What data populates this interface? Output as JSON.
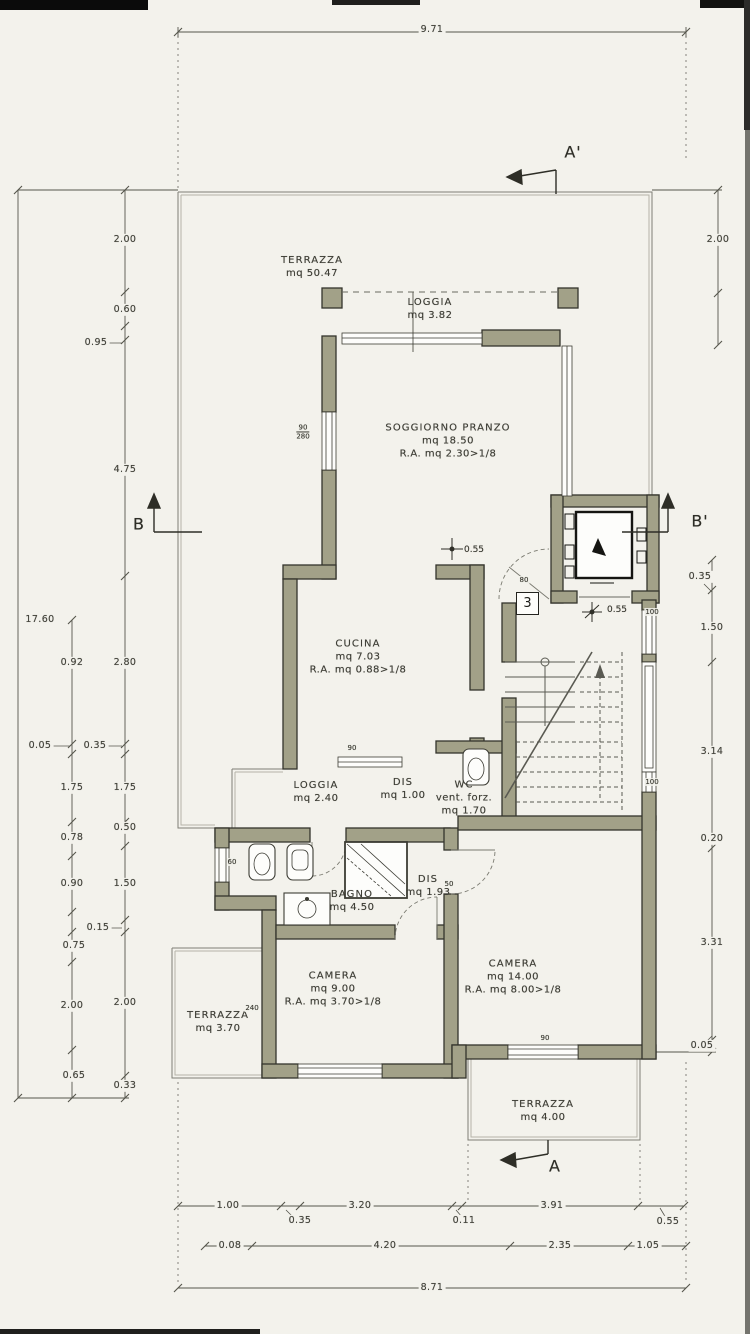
{
  "colors": {
    "paper": "#f3f2ec",
    "wall_fill": "#a2a188",
    "wall_stroke": "#34342c",
    "dim_line": "#55554c"
  },
  "unit_number": "3",
  "section_markers": {
    "a_top": "A'",
    "a_bottom": "A",
    "b_left": "B",
    "b_right": "B'"
  },
  "rooms": [
    {
      "id": "terrazza-grande",
      "cx": 312,
      "cy": 267,
      "lines": [
        "TERRAZZA",
        "mq 50.47"
      ]
    },
    {
      "id": "loggia-nord",
      "cx": 430,
      "cy": 309,
      "lines": [
        "LOGGIA",
        "mq 3.82"
      ]
    },
    {
      "id": "soggiorno-pranzo",
      "cx": 448,
      "cy": 441,
      "lines": [
        "SOGGIORNO PRANZO",
        "mq 18.50",
        "R.A. mq 2.30>1/8"
      ]
    },
    {
      "id": "cucina",
      "cx": 358,
      "cy": 657,
      "lines": [
        "CUCINA",
        "mq 7.03",
        "R.A. mq 0.88>1/8"
      ]
    },
    {
      "id": "loggia-ovest",
      "cx": 316,
      "cy": 792,
      "lines": [
        "LOGGIA",
        "mq 2.40"
      ]
    },
    {
      "id": "disimpegno-1",
      "cx": 403,
      "cy": 789,
      "lines": [
        "DIS",
        "mq 1.00"
      ]
    },
    {
      "id": "wc",
      "cx": 464,
      "cy": 798,
      "lines": [
        "WC",
        "vent. forz.",
        "mq 1.70"
      ]
    },
    {
      "id": "bagno",
      "cx": 352,
      "cy": 901,
      "lines": [
        "BAGNO",
        "mq 4.50"
      ]
    },
    {
      "id": "disimpegno-2",
      "cx": 428,
      "cy": 886,
      "lines": [
        "DIS",
        "mq 1.93"
      ]
    },
    {
      "id": "camera-1",
      "cx": 333,
      "cy": 989,
      "lines": [
        "CAMERA",
        "mq 9.00",
        "R.A. mq 3.70>1/8"
      ]
    },
    {
      "id": "camera-2",
      "cx": 513,
      "cy": 977,
      "lines": [
        "CAMERA",
        "mq 14.00",
        "R.A. mq 8.00>1/8"
      ]
    },
    {
      "id": "terrazza-ovest",
      "cx": 218,
      "cy": 1022,
      "lines": [
        "TERRAZZA",
        "mq 3.70"
      ]
    },
    {
      "id": "terrazza-sud",
      "cx": 543,
      "cy": 1111,
      "lines": [
        "TERRAZZA",
        "mq 4.00"
      ]
    }
  ],
  "dimensions": [
    {
      "x": 432,
      "y": 30,
      "t": "9.71"
    },
    {
      "x": 40,
      "y": 620,
      "t": "17.60"
    },
    {
      "x": 125,
      "y": 240,
      "t": "2.00"
    },
    {
      "x": 125,
      "y": 310,
      "t": "0.60"
    },
    {
      "x": 96,
      "y": 343,
      "t": "0.95"
    },
    {
      "x": 125,
      "y": 470,
      "t": "4.75"
    },
    {
      "x": 125,
      "y": 663,
      "t": "2.80"
    },
    {
      "x": 95,
      "y": 746,
      "t": "0.35"
    },
    {
      "x": 125,
      "y": 788,
      "t": "1.75"
    },
    {
      "x": 125,
      "y": 828,
      "t": "0.50"
    },
    {
      "x": 125,
      "y": 884,
      "t": "1.50"
    },
    {
      "x": 98,
      "y": 928,
      "t": "0.15"
    },
    {
      "x": 125,
      "y": 1003,
      "t": "2.00"
    },
    {
      "x": 125,
      "y": 1086,
      "t": "0.33"
    },
    {
      "x": 72,
      "y": 663,
      "t": "0.92"
    },
    {
      "x": 40,
      "y": 746,
      "t": "0.05"
    },
    {
      "x": 72,
      "y": 788,
      "t": "1.75"
    },
    {
      "x": 72,
      "y": 838,
      "t": "0.78"
    },
    {
      "x": 72,
      "y": 884,
      "t": "0.90"
    },
    {
      "x": 74,
      "y": 946,
      "t": "0.75"
    },
    {
      "x": 72,
      "y": 1006,
      "t": "2.00"
    },
    {
      "x": 74,
      "y": 1076,
      "t": "0.65"
    },
    {
      "x": 718,
      "y": 240,
      "t": "2.00"
    },
    {
      "x": 700,
      "y": 577,
      "t": "0.35"
    },
    {
      "x": 712,
      "y": 628,
      "t": "1.50"
    },
    {
      "x": 712,
      "y": 752,
      "t": "3.14"
    },
    {
      "x": 712,
      "y": 839,
      "t": "0.20"
    },
    {
      "x": 712,
      "y": 943,
      "t": "3.31"
    },
    {
      "x": 702,
      "y": 1046,
      "t": "0.05"
    },
    {
      "x": 228,
      "y": 1206,
      "t": "1.00"
    },
    {
      "x": 300,
      "y": 1221,
      "t": "0.35"
    },
    {
      "x": 360,
      "y": 1206,
      "t": "3.20"
    },
    {
      "x": 464,
      "y": 1221,
      "t": "0.11"
    },
    {
      "x": 552,
      "y": 1206,
      "t": "3.91"
    },
    {
      "x": 668,
      "y": 1222,
      "t": "0.55"
    },
    {
      "x": 230,
      "y": 1246,
      "t": "0.08"
    },
    {
      "x": 385,
      "y": 1246,
      "t": "4.20"
    },
    {
      "x": 560,
      "y": 1246,
      "t": "2.35"
    },
    {
      "x": 648,
      "y": 1246,
      "t": "1.05"
    },
    {
      "x": 432,
      "y": 1288,
      "t": "8.71"
    }
  ],
  "window_tags": [
    {
      "x": 303,
      "y": 432,
      "lines": [
        "90",
        "280"
      ]
    },
    {
      "x": 652,
      "y": 612,
      "lines": [
        "100"
      ]
    },
    {
      "x": 652,
      "y": 782,
      "lines": [
        "100"
      ]
    },
    {
      "x": 352,
      "y": 748,
      "lines": [
        "90"
      ]
    },
    {
      "x": 232,
      "y": 862,
      "lines": [
        "60"
      ]
    },
    {
      "x": 545,
      "y": 1038,
      "lines": [
        "90"
      ]
    },
    {
      "x": 524,
      "y": 580,
      "lines": [
        "80"
      ]
    },
    {
      "x": 252,
      "y": 1008,
      "lines": [
        "240"
      ]
    },
    {
      "x": 449,
      "y": 884,
      "lines": [
        "50"
      ]
    }
  ],
  "level_marks": [
    {
      "x": 474,
      "y": 551,
      "t": "0.55"
    },
    {
      "x": 617,
      "y": 611,
      "t": "0.55"
    }
  ]
}
